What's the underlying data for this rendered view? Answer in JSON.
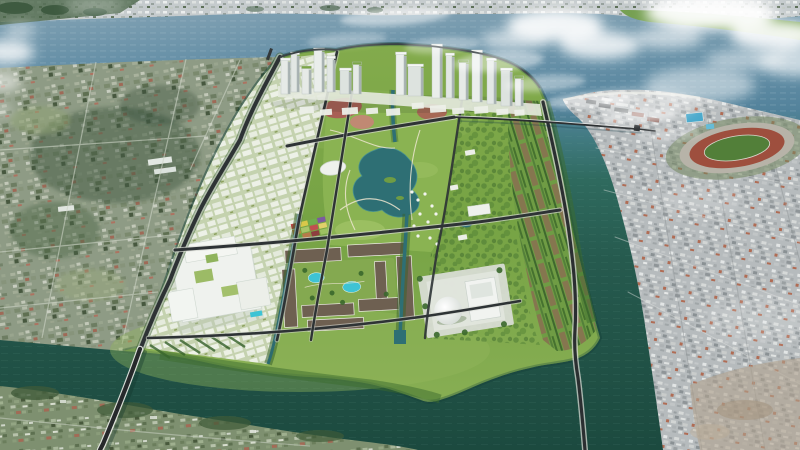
{
  "scene": {
    "type": "aerial-3d-masterplan-render",
    "description": "Aerial rendering of a master-planned green island city district with a central park, lake, canals, waterfront towers and bridges, surrounded by dark teal river water, with existing low-rise city fabric on the left bank, a dense city with an oval stadium on the right bank, a distant shoreline across the blue river at top, and white clouds drifting over the water"
  },
  "palette": {
    "river_blue": "#5f87a0",
    "dark_water": "#235749",
    "island_green": "#7ca746",
    "tree_green": "#3c6b2e",
    "lawn_light": "#a6c76d",
    "tower_white": "#e6eae7",
    "road_dark": "#2e3335",
    "bridge_deck": "#26292b",
    "cloud_white": "#ffffff",
    "left_bank_base": "#8e9b85",
    "right_bank_base": "#b6bbbd",
    "stadium_track": "#9e4f3e",
    "stadium_field": "#527f39",
    "lagoon_pool": "#3ec3d4",
    "plaza_red": "#a85f55",
    "park_lake": "#2e6f74",
    "rowhouse_roof": "#6e6051",
    "white_campus": "#eff2ee",
    "dome_white": "#f4f6f3",
    "garden_plot_red": "#b34440",
    "garden_plot_yellow": "#d8c84a"
  },
  "landmarks": {
    "far_shore": "distant city shoreline strip",
    "river": "wide blue river",
    "left_bank_city": "existing suburb with fields and forest",
    "right_bank_city": "dense existing city blocks",
    "stadium": "oval stadium with red running track",
    "island": "green island development",
    "waterfront_towers": "high-rise cluster on north waterfront",
    "central_park": "central park with lake, canals and red plazas",
    "residential_quarter": "courtyard housing with turquoise lagoon pools",
    "white_campus": "large white low-rise complex",
    "dome_hall": "cultural hall with white dome",
    "garden_plots": "colorful farm plots",
    "east_terraces": "rows of terraced green-roof buildings",
    "bridge_count": 3,
    "cloud_groups": 5
  }
}
